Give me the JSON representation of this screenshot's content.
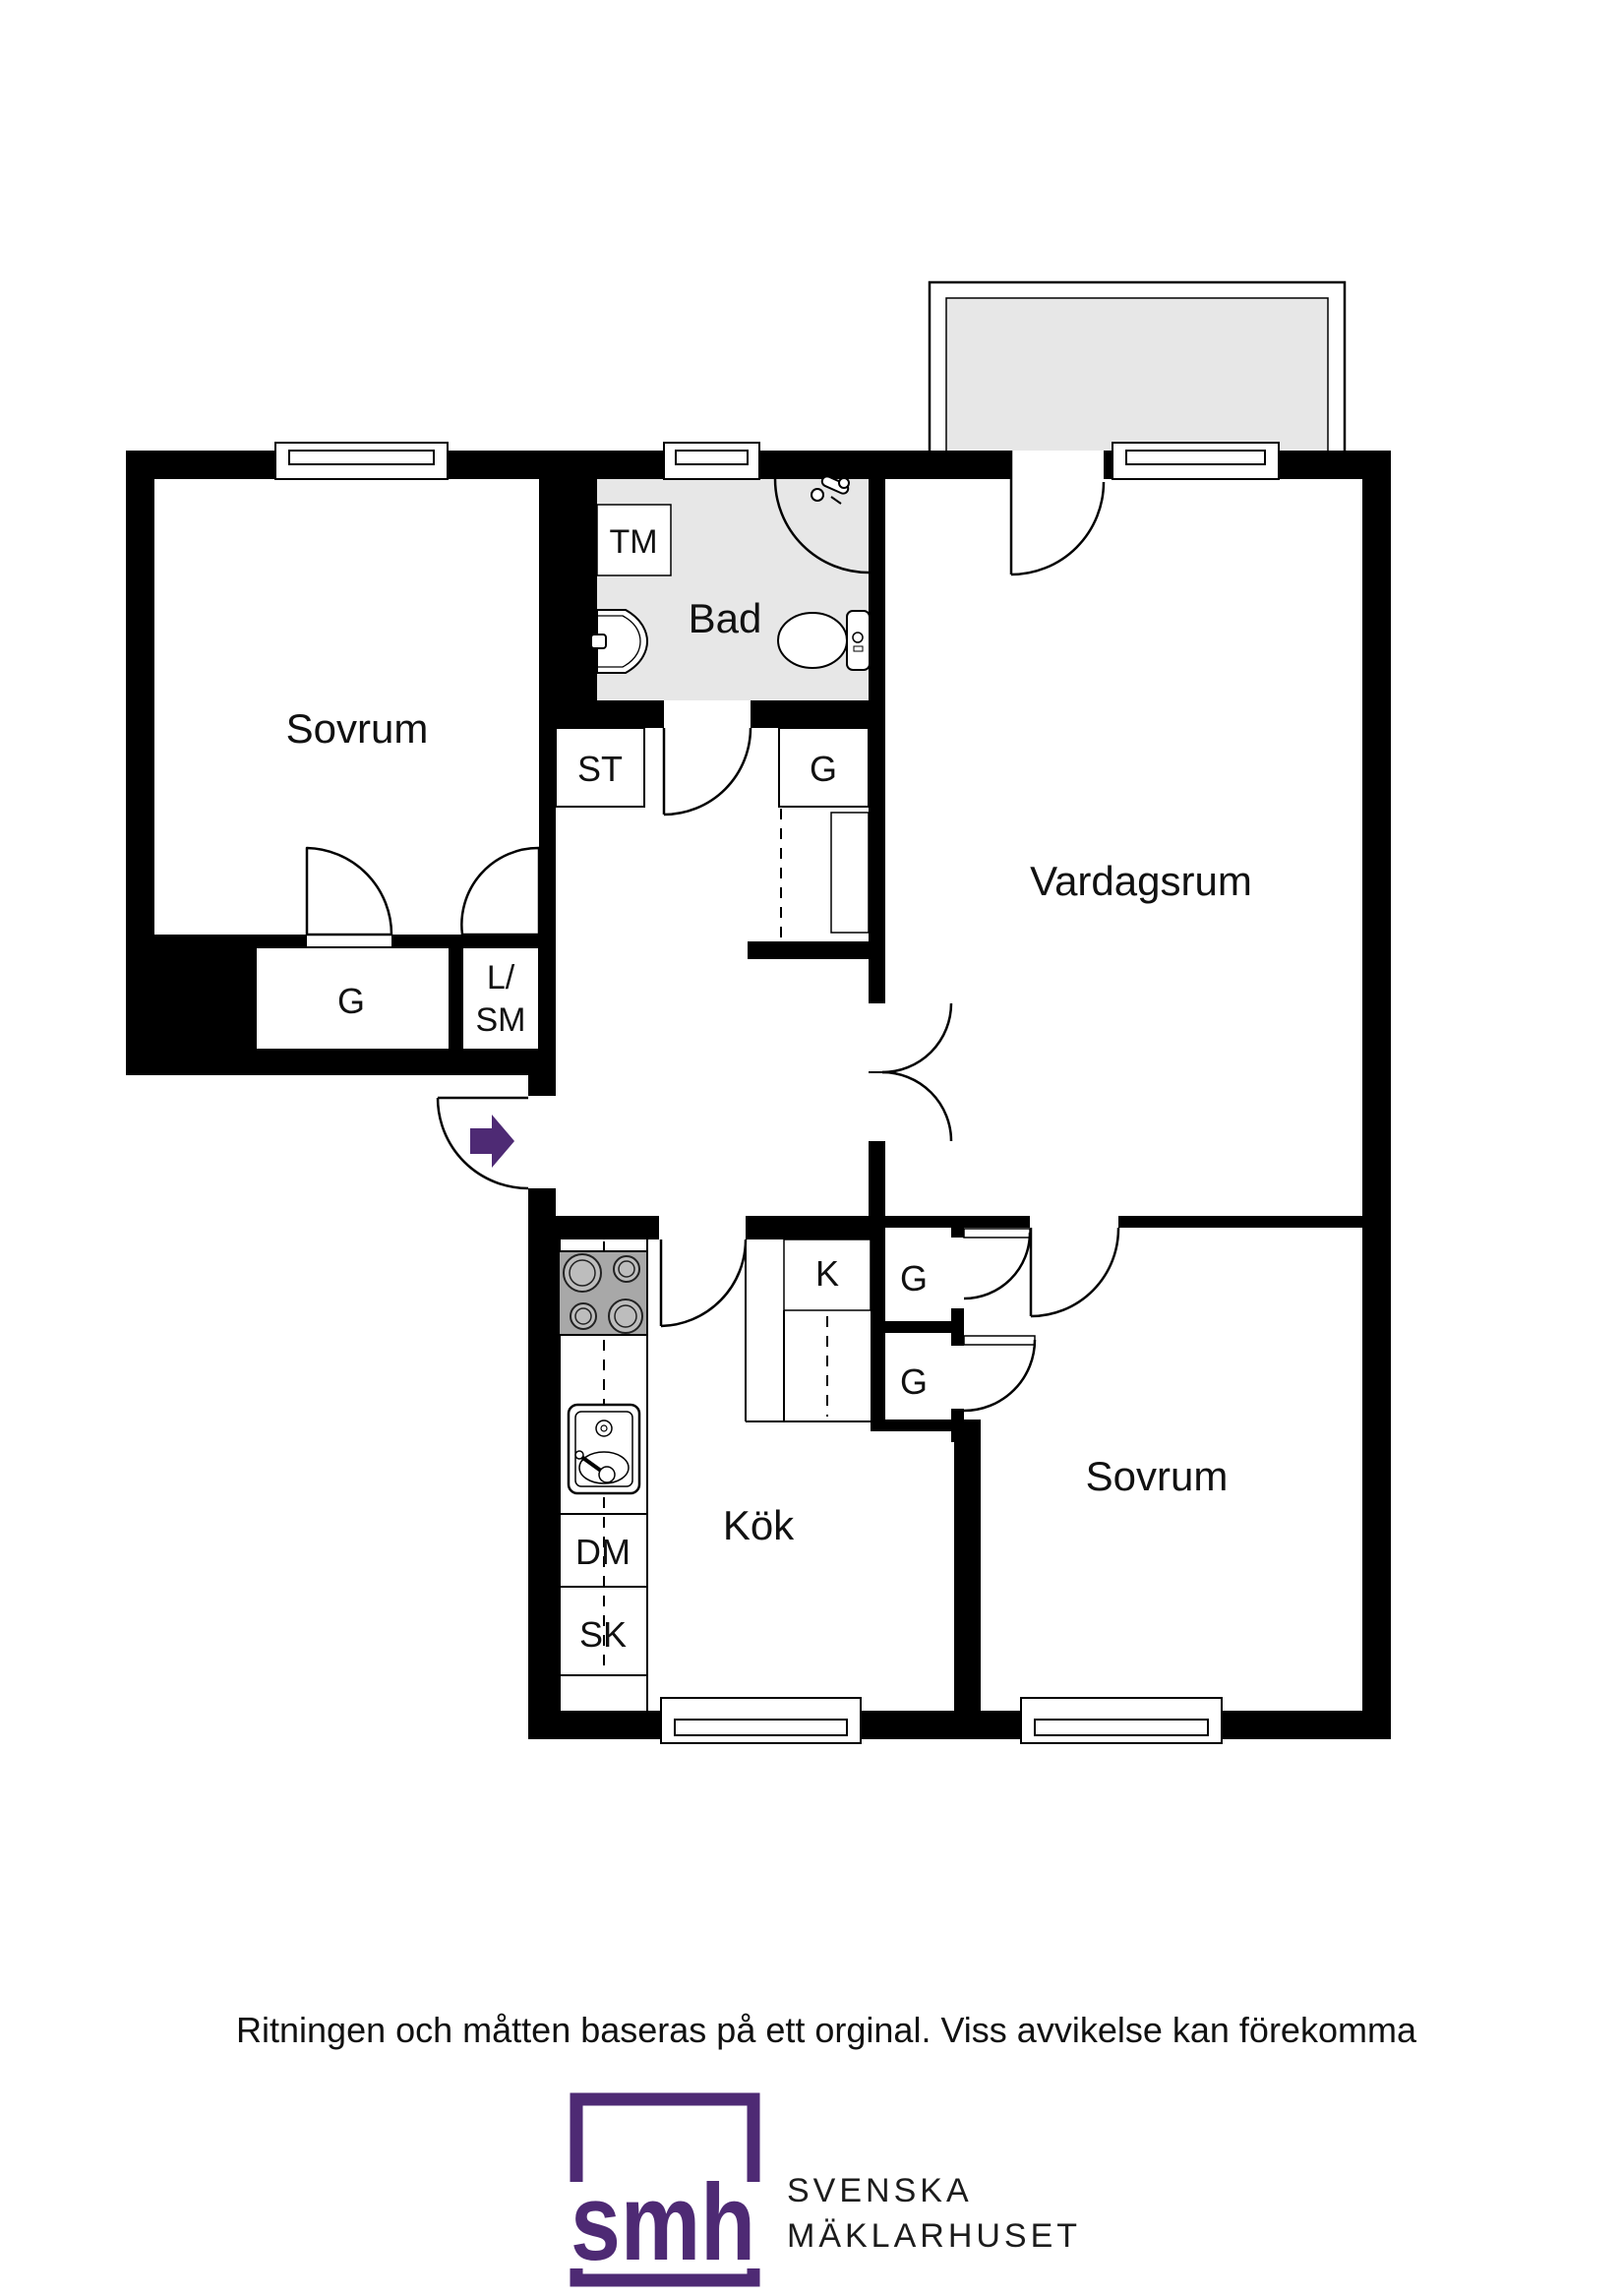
{
  "plan": {
    "rooms": {
      "bedroom_left": "Sovrum",
      "bathroom": "Bad",
      "living_room": "Vardagsrum",
      "kitchen": "Kök",
      "bedroom_right": "Sovrum"
    },
    "labels": {
      "washing_machine": "TM",
      "closet_st": "ST",
      "closet_hall_g": "G",
      "closet_bedroom_left_g": "G",
      "linen_cleaning_line1": "L/",
      "linen_cleaning_line2": "SM",
      "fridge_k": "K",
      "closet_upper_g": "G",
      "closet_lower_g": "G",
      "dishwasher": "DM",
      "tall_cabinet": "SK"
    }
  },
  "disclaimer": "Ritningen och måtten baseras på ett orginal. Viss avvikelse kan förekomma",
  "logo": {
    "monogram": "smh",
    "name_line1": "SVENSKA",
    "name_line2": "MÄKLARHUSET"
  },
  "colors": {
    "accent_purple": "#4e2a74",
    "wall_black": "#000000",
    "floor_gray": "#e7e7e7",
    "stove_gray": "#a8a8a8"
  }
}
